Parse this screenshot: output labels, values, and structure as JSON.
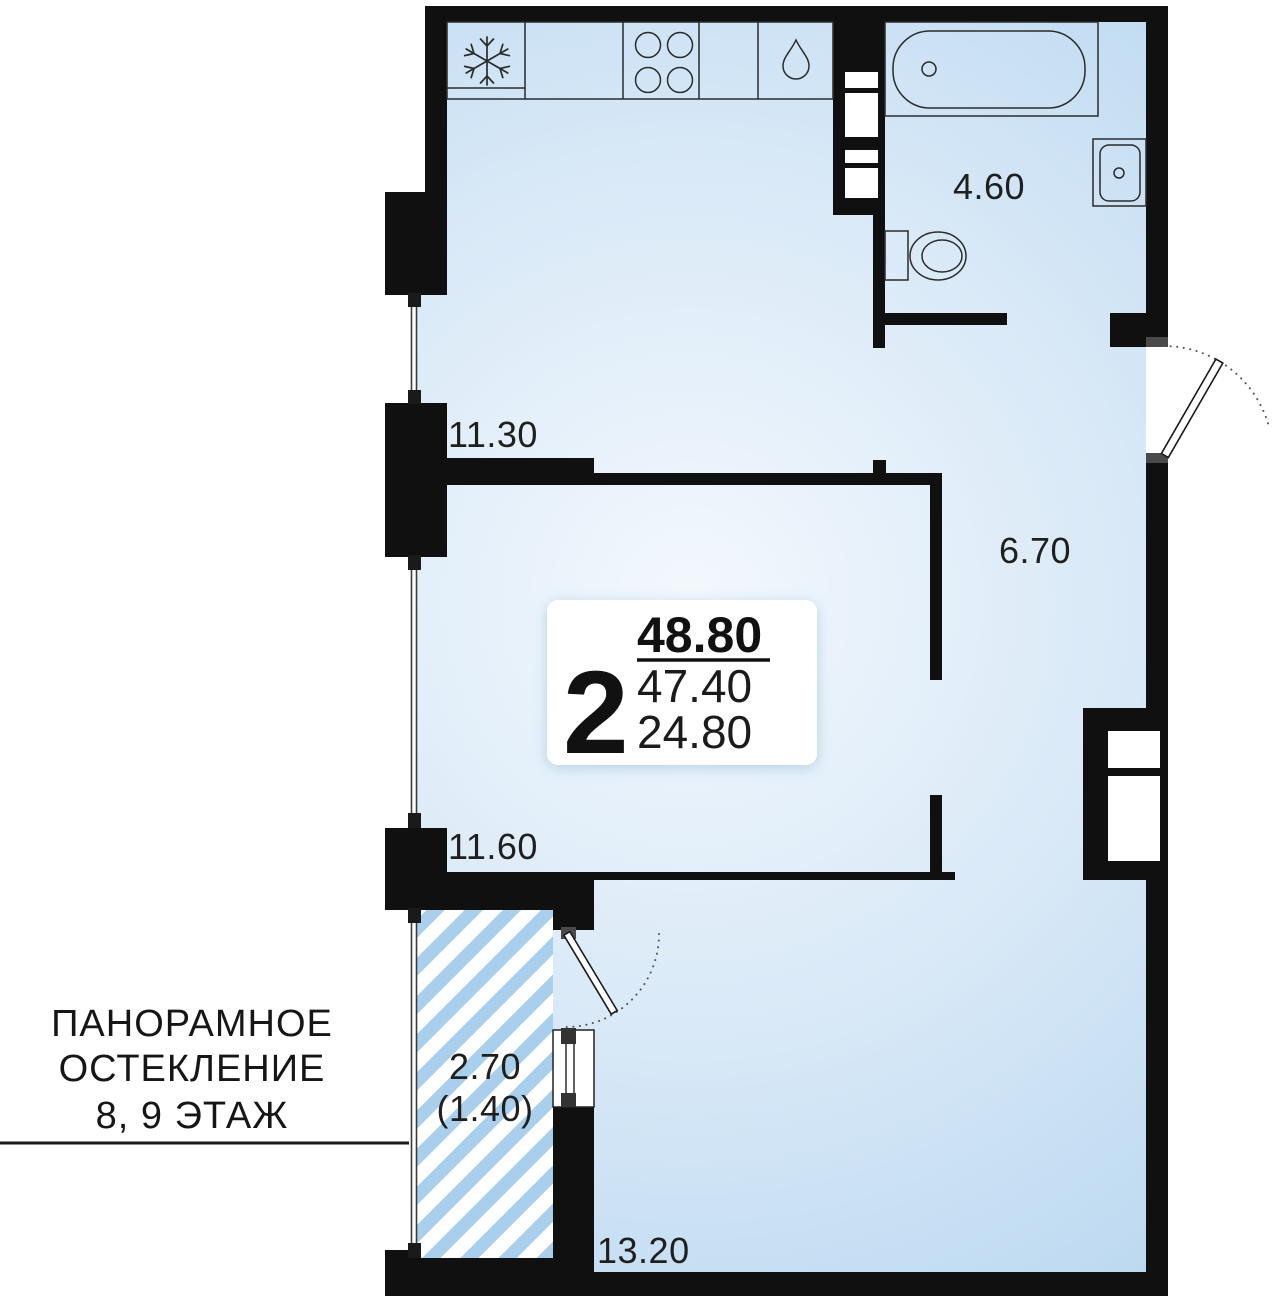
{
  "plan": {
    "info_card": {
      "rooms_count": "2",
      "area_total": "48.80",
      "area_without_balcony": "47.40",
      "area_living": "24.80"
    },
    "room_labels": {
      "kitchen_living": "11.30",
      "bathroom": "4.60",
      "hallway": "6.70",
      "bedroom": "11.60",
      "living_room": "13.20",
      "balcony": "2.70",
      "balcony_reduced": "(1.40)"
    },
    "annotation": {
      "line1": "ПАНОРАМНОЕ",
      "line2": "ОСТЕКЛЕНИЕ",
      "line3": "8, 9 ЭТАЖ"
    },
    "icons": {
      "fridge": "snowflake-icon",
      "stove": "four-burners-icon",
      "kitchen_sink": "water-drop-icon"
    },
    "colors": {
      "wall": "#101010",
      "room_fill_center": "#f3f8fd",
      "room_fill_edge": "#b9d7f0",
      "balcony_hatch_stripe": "#a9cfec",
      "door_jamb": "#4a4a4a",
      "text": "#1f1f1f",
      "card_bg": "#ffffff"
    }
  }
}
